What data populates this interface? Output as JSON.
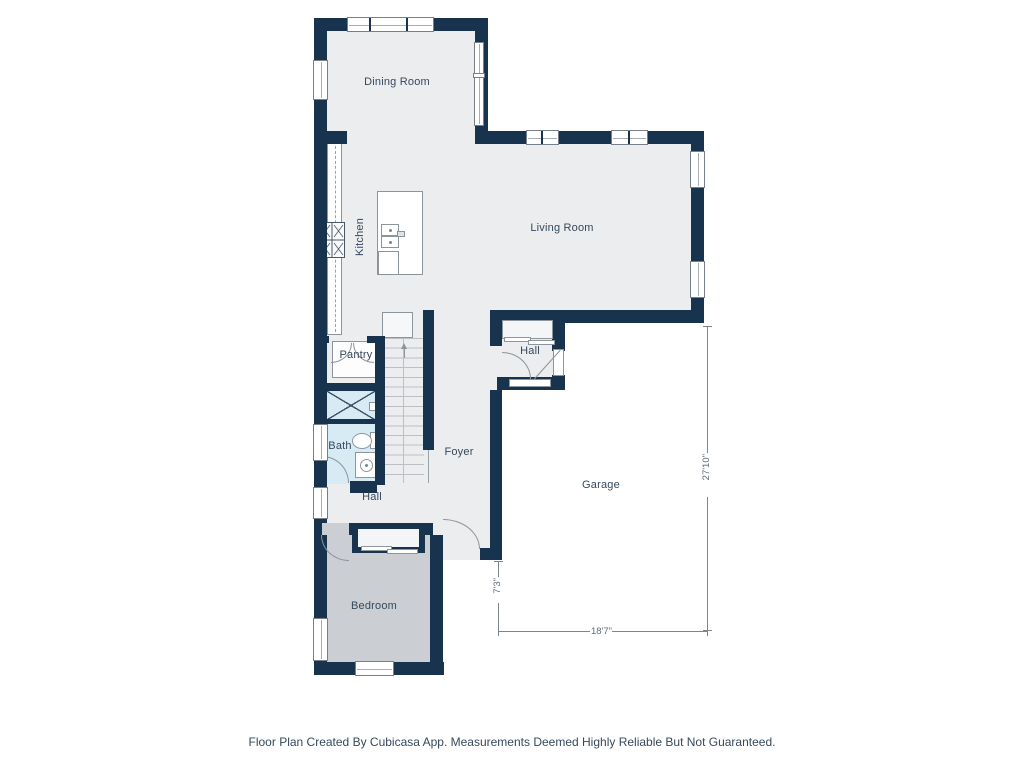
{
  "plan": {
    "rooms": {
      "dining_room": "Dining Room",
      "living_room": "Living Room",
      "kitchen": "Kitchen",
      "pantry": "Pantry",
      "bath": "Bath",
      "hall": "Hall",
      "hall_entry": "Hall",
      "foyer": "Foyer",
      "garage": "Garage",
      "bedroom": "Bedroom"
    },
    "dimensions": {
      "garage_depth": "27'10\"",
      "entry_inset": "7'3\"",
      "garage_width": "18'7\""
    }
  },
  "footer": "Floor Plan Created By Cubicasa App. Measurements Deemed Highly Reliable But Not Guaranteed.",
  "colors": {
    "wall": "#17334d",
    "floor": "#ecedee",
    "wet": "#d7ebf5",
    "bedroom": "#cbced2",
    "line": "#8d959c",
    "stair": "#bcc0c4",
    "ink": "#35495c",
    "dim": "#7c858d",
    "dimtext": "#5d6c79"
  }
}
